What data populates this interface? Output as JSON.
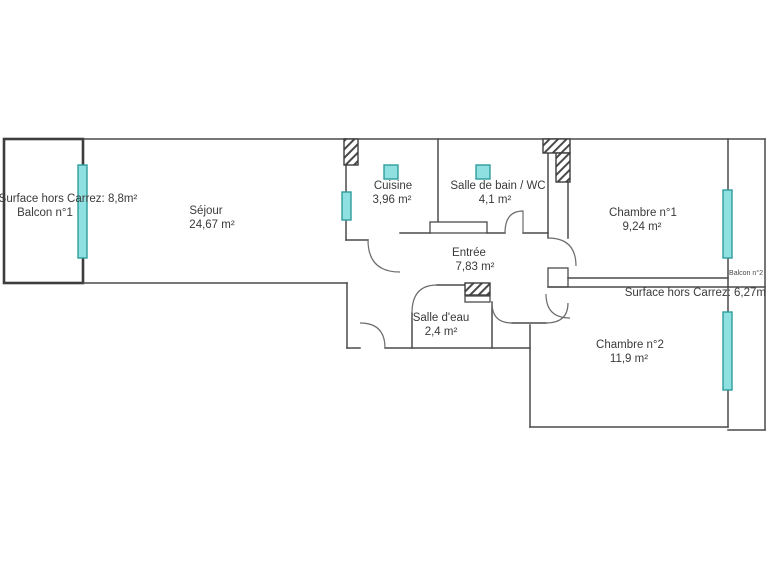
{
  "plan_type": "apartment-floor-plan",
  "rooms": [
    {
      "label": "Séjour",
      "area": "24,67 m²"
    },
    {
      "label": "Cuisine",
      "area": "3,96 m²"
    },
    {
      "label": "Salle de bain / WC",
      "area": "4,1 m²"
    },
    {
      "label": "Chambre n°1",
      "area": "9,24 m²"
    },
    {
      "label": "Entrée",
      "area": "7,83 m²"
    },
    {
      "label": "Salle d'eau",
      "area": "2,4 m²"
    },
    {
      "label": "Chambre n°2",
      "area": "11,9 m²"
    }
  ],
  "balconies": [
    {
      "surface_label": "Surface hors Carrez: 8,8m²",
      "label": "Balcon n°1"
    },
    {
      "label": "Balcon n°2",
      "surface_label": "Surface hors Carrez: 6,27m"
    }
  ],
  "colors": {
    "background": "#ffffff",
    "wall": "#4a4a4a",
    "text": "#3a3a3a",
    "window_fill": "#8fe0e0",
    "window_border": "#2e9c9c"
  }
}
